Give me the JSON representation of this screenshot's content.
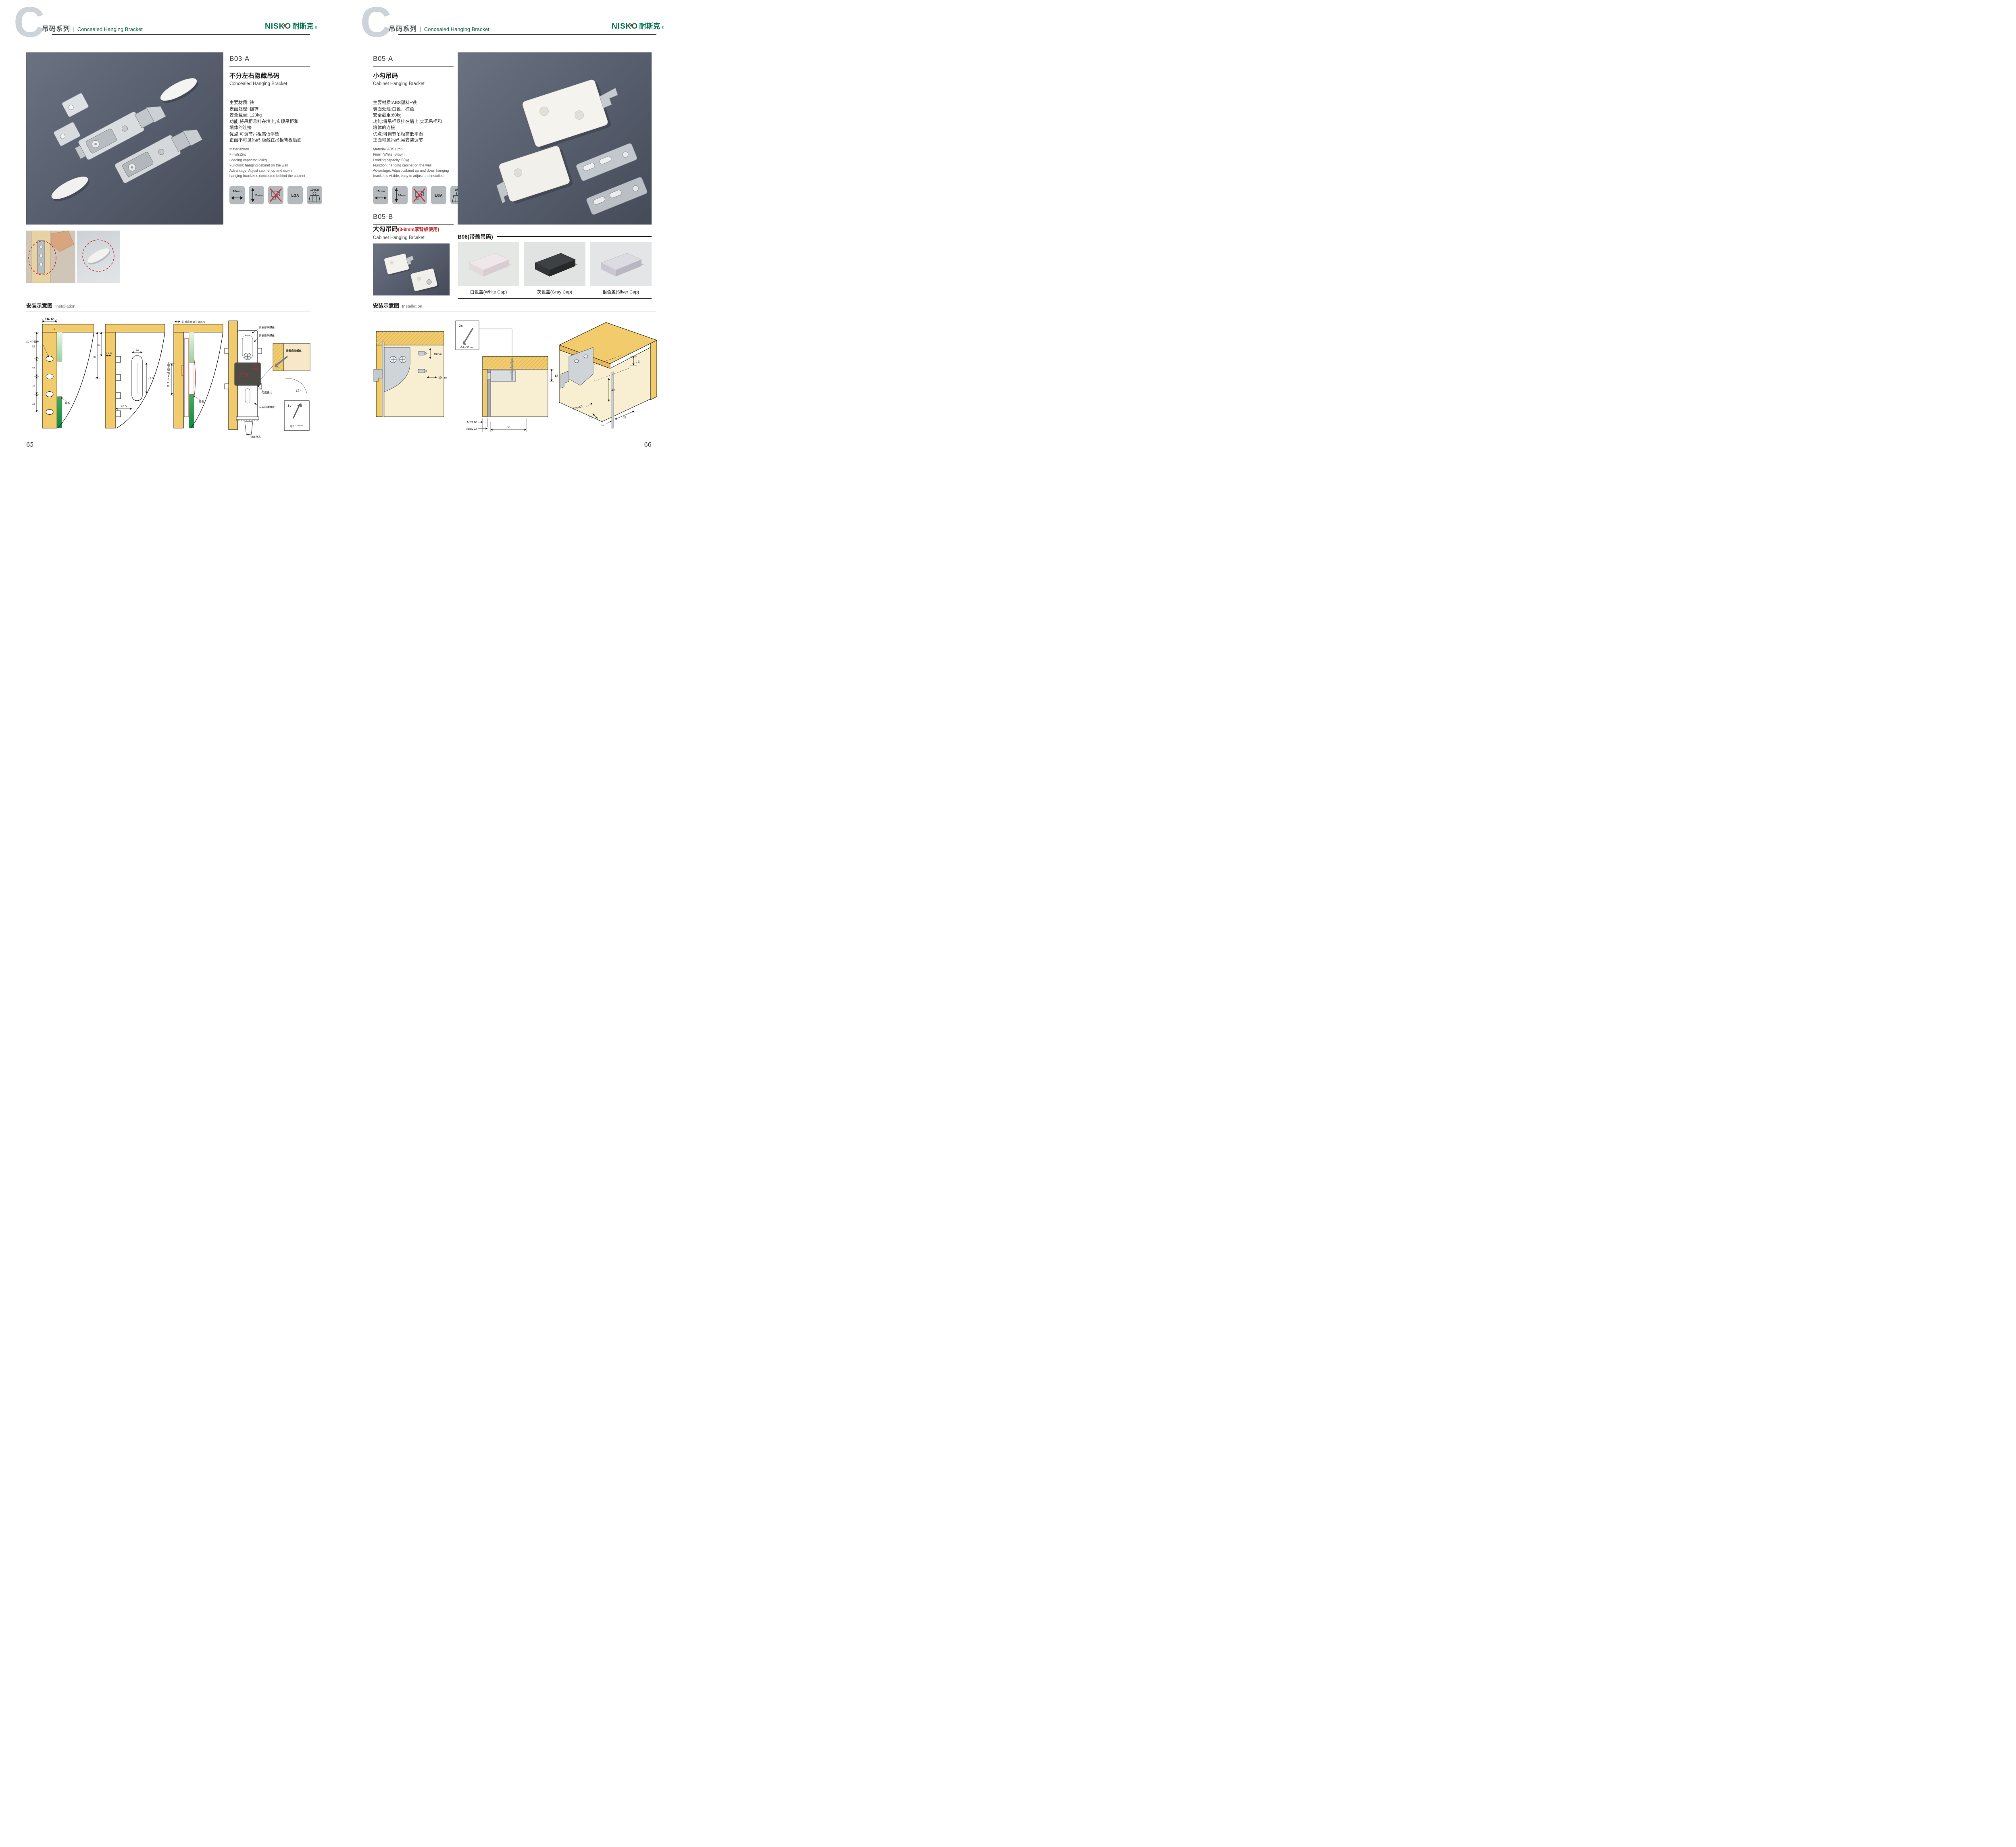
{
  "header": {
    "letter": "C",
    "title_cn": "吊码系列",
    "title_en": "Concealed Hanging Bracket",
    "brand": "NISKO",
    "brand_cn": "耐斯克",
    "reg": "®"
  },
  "colors": {
    "accent_green": "#156749",
    "brand_green": "#00724a",
    "warning_red": "#c0272d",
    "wood_tan": "#f2cb6d",
    "photo_slate": "#596070",
    "icon_gray": "#b3b9bc",
    "cap_white": "#efe7ea",
    "cap_gray": "#3e4144",
    "cap_silver": "#dcdae2"
  },
  "left": {
    "code": "B03-A",
    "name_cn": "不分左右隐藏吊码",
    "name_en": "Concealed Hanging Bracket",
    "specs_cn": [
      "主要材质: 铁",
      "表面处理: 镀锌",
      "安全载重: 120kg",
      "功能:将吊柜悬挂在墙上,实现吊柜和",
      "墙体的连接",
      "优点:可调节吊柜高低平衡",
      "正面不可见吊码,隐藏在吊柜背板后面"
    ],
    "specs_en": [
      "Material:Iron",
      "Finish:Zinc",
      "Loading capacity:120kg",
      "Function: hanging cabinet on the wall",
      "Advantage: Adjust cabinet up and down",
      "hanging bracket is concealed behind the cabinet"
    ],
    "icons": {
      "i1": "10mm",
      "i2": "10mm",
      "i4": "LGA",
      "i5": "120Kg"
    },
    "install_cn": "安装示意图",
    "install_en": "Installation",
    "d1": {
      "dim_top": "16-18",
      "dim5": "5",
      "chain": [
        "35",
        "32",
        "32",
        "32"
      ],
      "holes_label": "10-4个均布",
      "panel_label": "背板"
    },
    "d2": {
      "d35": "35",
      "d60": "60",
      "d125": "12.5",
      "d12": "12",
      "d425": "42.5",
      "d205": "20.5"
    },
    "d3": {
      "top_label": "前后最大调节10mm",
      "side_label": "上下调节10mm",
      "panel_label": "背板"
    },
    "d4": {
      "screw_label": "安装自攻螺丝",
      "plate_label": "专用挂片",
      "lock_label": "锁紧状态",
      "angle": "45°",
      "qty": "1x",
      "screw_size": "φ3.5mm"
    },
    "page_no": "65"
  },
  "right": {
    "a": {
      "code": "B05-A",
      "name_cn": "小勾吊码",
      "name_en": "Cabinet Hanging Bracket",
      "specs_cn": [
        "主要材质:ABS塑料+铁",
        "表面处理:白色、棕色",
        "安全载重:60kg",
        "功能:将吊柜悬挂在墙上,实现吊柜和",
        "墙体的连接",
        "优点:可调节吊柜高低平衡",
        "正面可见吊码,易安装调节"
      ],
      "specs_en": [
        "Material: ABS+Iron",
        "Finish:White, Brown",
        "Loading capacity: 60kg",
        "Function: hanging cabinet on the wall",
        "Advantage: Adjust cabinet up and down hanging",
        "bracket is visible, easy to adjust and installed"
      ],
      "icons": {
        "i1": "15mm",
        "i2": "10mm",
        "i4": "LGA",
        "i5": "60Kg"
      }
    },
    "b": {
      "code": "B05-B",
      "name_cn": "大勾吊码",
      "name_note": "(3-9mm厚背板使用)",
      "name_en": "Cabinet Hanging Brcaket"
    },
    "c": {
      "title": "B06(带盖吊码)",
      "cap1": "白色盖(White Cap)",
      "cap2": "灰色盖(Gray Cap)",
      "cap3": "银色盖(Silver Cap)"
    },
    "install_cn": "安装示意图",
    "install_en": "Installation",
    "rd1": {
      "d10": "10mm",
      "d15": "15mm"
    },
    "rd2": {
      "qty": "2x",
      "screw_size": "Φ4×30mm",
      "d18": "18",
      "dmin": "MIN.10",
      "dmax": "MAX.23",
      "d58": "58"
    },
    "rd3": {
      "d16a": "16",
      "d42": "42",
      "rmax": "RMAX4",
      "d16b": "16",
      "d17": "17",
      "d32": "32"
    },
    "page_no": "66"
  }
}
